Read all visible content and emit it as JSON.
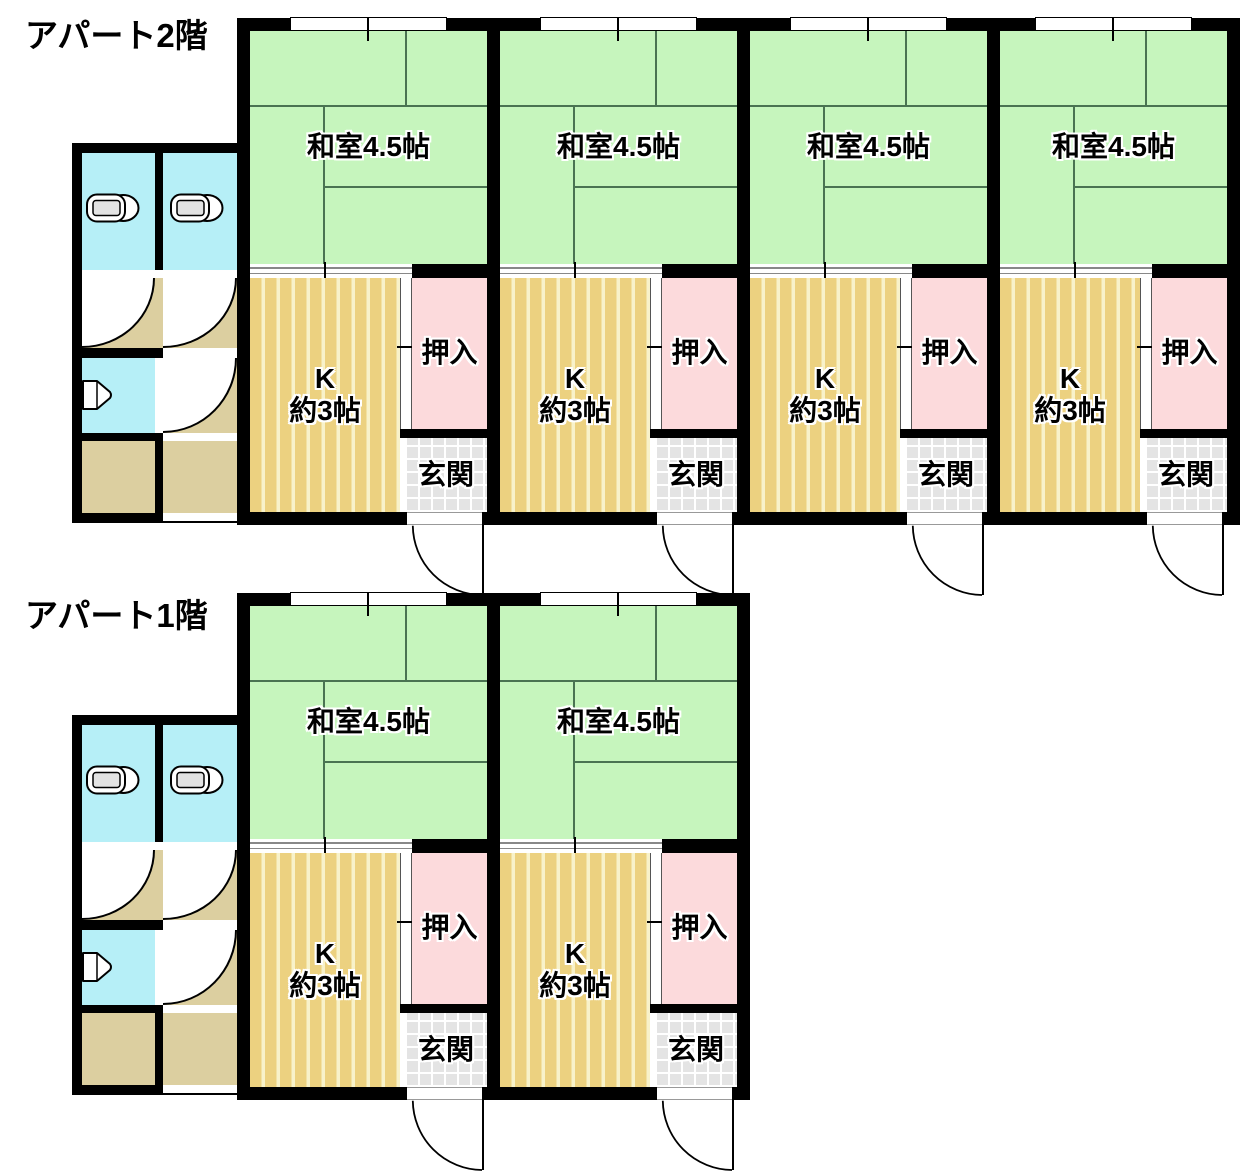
{
  "floors": [
    {
      "label": "アパート2階",
      "units": [
        {
          "washitsu": "和室4.5帖",
          "k1": "K",
          "k2": "約3帖",
          "oshiire": "押入",
          "genkan": "玄関"
        },
        {
          "washitsu": "和室4.5帖",
          "k1": "K",
          "k2": "約3帖",
          "oshiire": "押入",
          "genkan": "玄関"
        },
        {
          "washitsu": "和室4.5帖",
          "k1": "K",
          "k2": "約3帖",
          "oshiire": "押入",
          "genkan": "玄関"
        },
        {
          "washitsu": "和室4.5帖",
          "k1": "K",
          "k2": "約3帖",
          "oshiire": "押入",
          "genkan": "玄関"
        }
      ]
    },
    {
      "label": "アパート1階",
      "units": [
        {
          "washitsu": "和室4.5帖",
          "k1": "K",
          "k2": "約3帖",
          "oshiire": "押入",
          "genkan": "玄関"
        },
        {
          "washitsu": "和室4.5帖",
          "k1": "K",
          "k2": "約3帖",
          "oshiire": "押入",
          "genkan": "玄関"
        }
      ]
    }
  ],
  "icons": {
    "toilet": "toilet-icon",
    "urinal": "urinal-icon",
    "door_swing": "door-swing-arc",
    "window": "window"
  },
  "colors": {
    "wall": "#000000",
    "tatami_green": "#c6f5bd",
    "tatami_line": "#4a7352",
    "kitchen_gold": "#ecd180",
    "kitchen_stripe": "#f8f2ca",
    "closet_pink": "#fcdadc",
    "entrance_gray": "#e4e4e4",
    "toilet_cyan": "#b6eff7",
    "corridor_tan": "#dccfa0",
    "door_line": "#888888",
    "fixture_fill": "#e3e3e3"
  }
}
